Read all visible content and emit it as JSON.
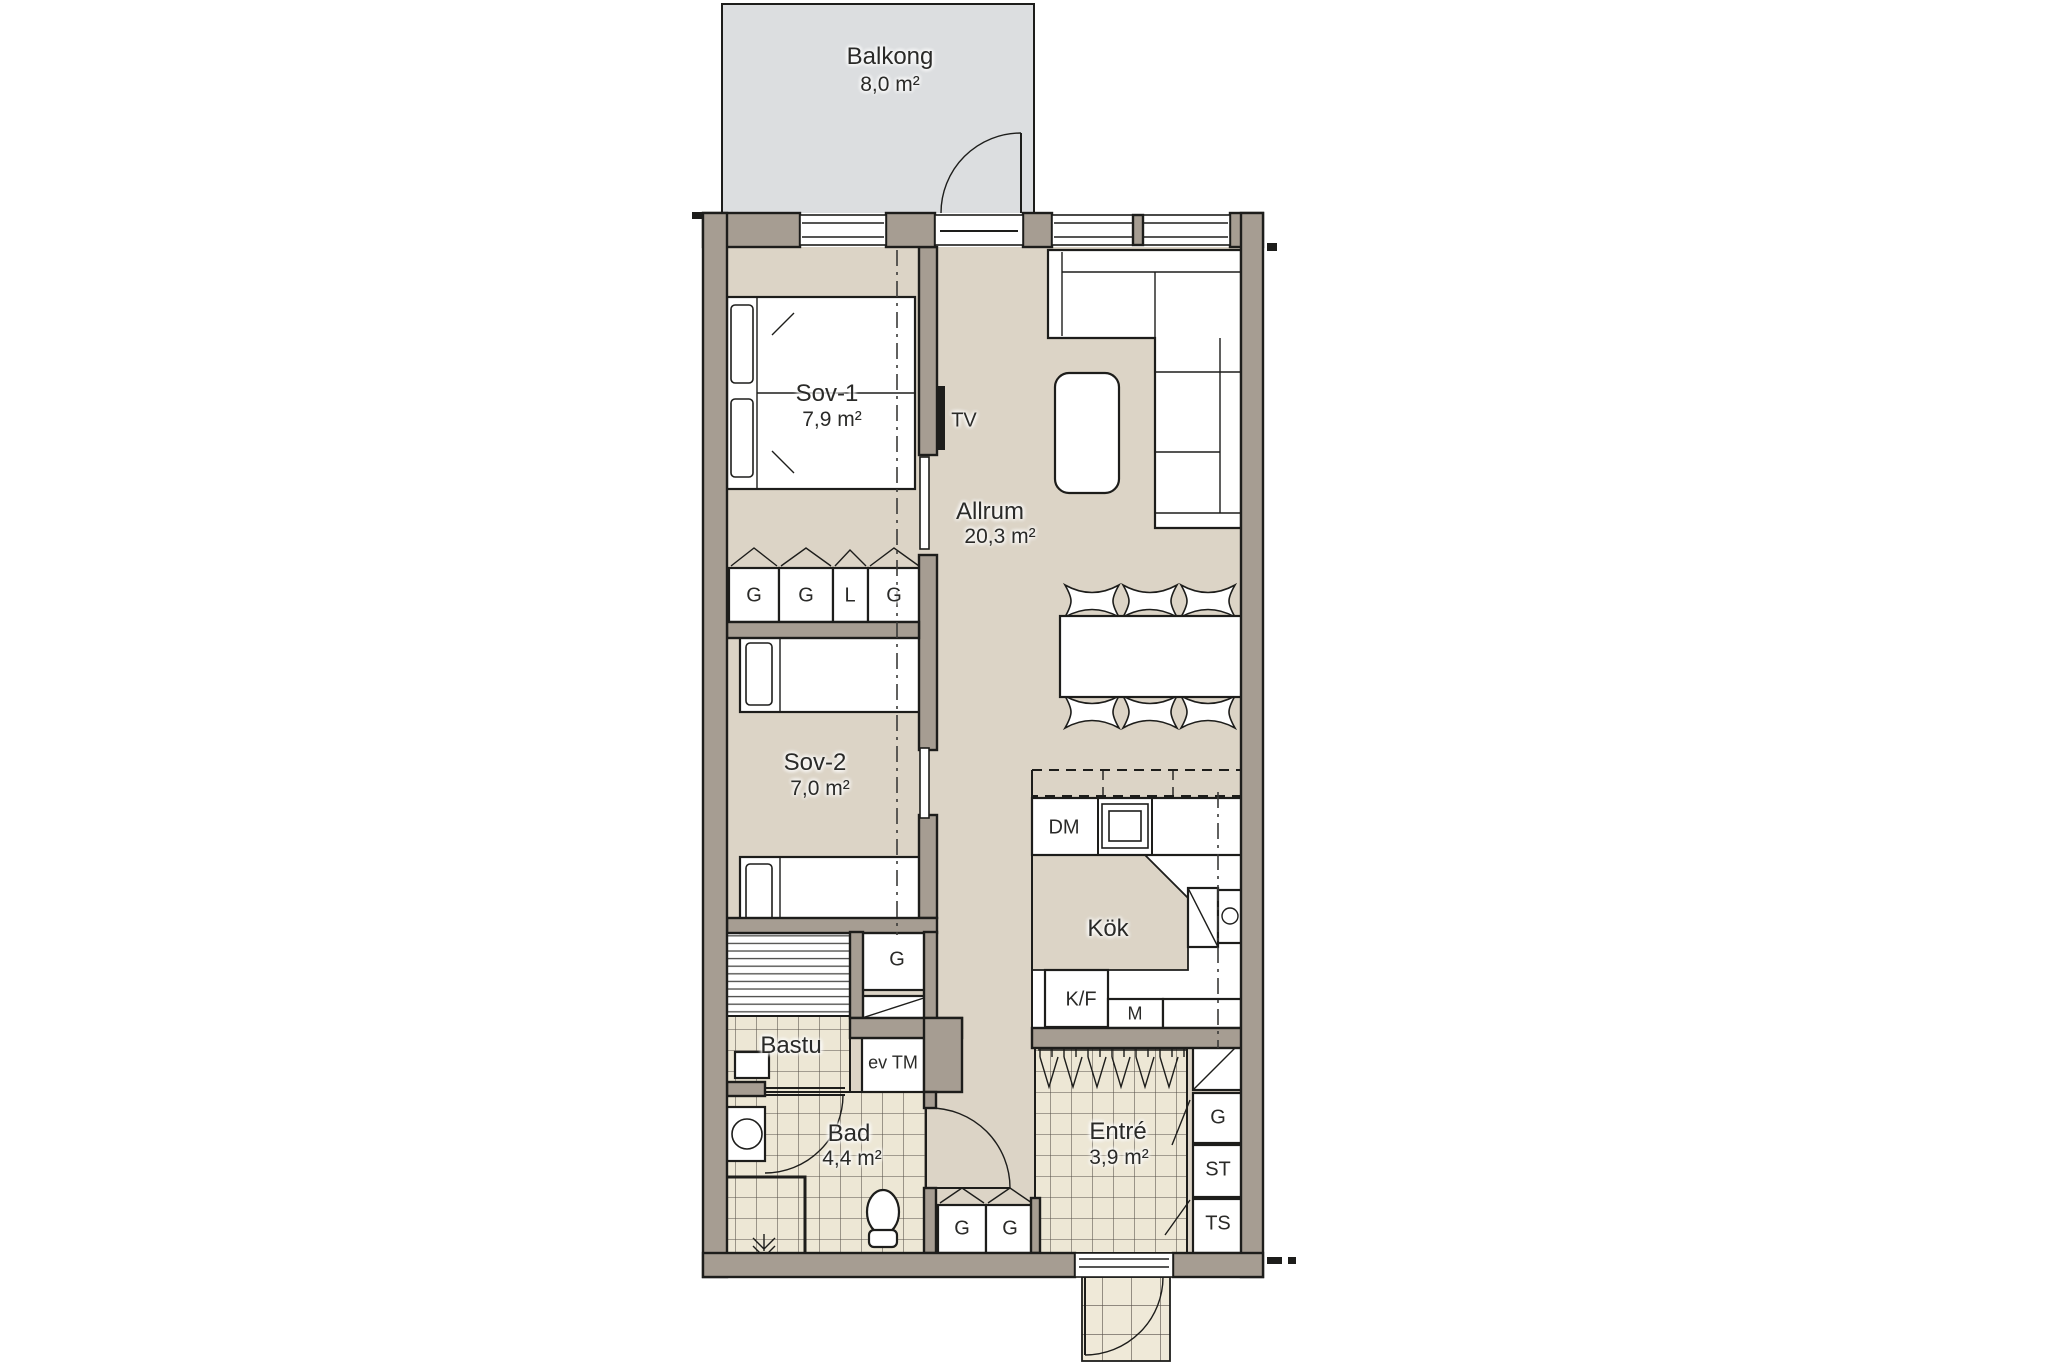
{
  "rooms": {
    "balkong": {
      "name": "Balkong",
      "area": "8,0 m²"
    },
    "sov1": {
      "name": "Sov-1",
      "area": "7,9 m²"
    },
    "allrum": {
      "name": "Allrum",
      "area": "20,3 m²"
    },
    "sov2": {
      "name": "Sov-2",
      "area": "7,0 m²"
    },
    "kok": {
      "name": "Kök"
    },
    "bastu": {
      "name": "Bastu"
    },
    "bad": {
      "name": "Bad",
      "area": "4,4 m²"
    },
    "entre": {
      "name": "Entré",
      "area": "3,9 m²"
    }
  },
  "fixtures": {
    "tv": "TV",
    "dm": "DM",
    "kf": "K/F",
    "m": "M",
    "evtm": "ev TM"
  },
  "closets": {
    "sov1_row": [
      "G",
      "G",
      "L",
      "G"
    ],
    "sov2_g": "G",
    "hall_row": [
      "G",
      "G"
    ],
    "entre_col": [
      "G",
      "ST",
      "TS"
    ]
  },
  "colors": {
    "wall": "#a69d92",
    "floor": "#dcd4c6",
    "tile": "#ede7d5",
    "balcony": "#dcdee0",
    "line": "#1d1d1b"
  }
}
